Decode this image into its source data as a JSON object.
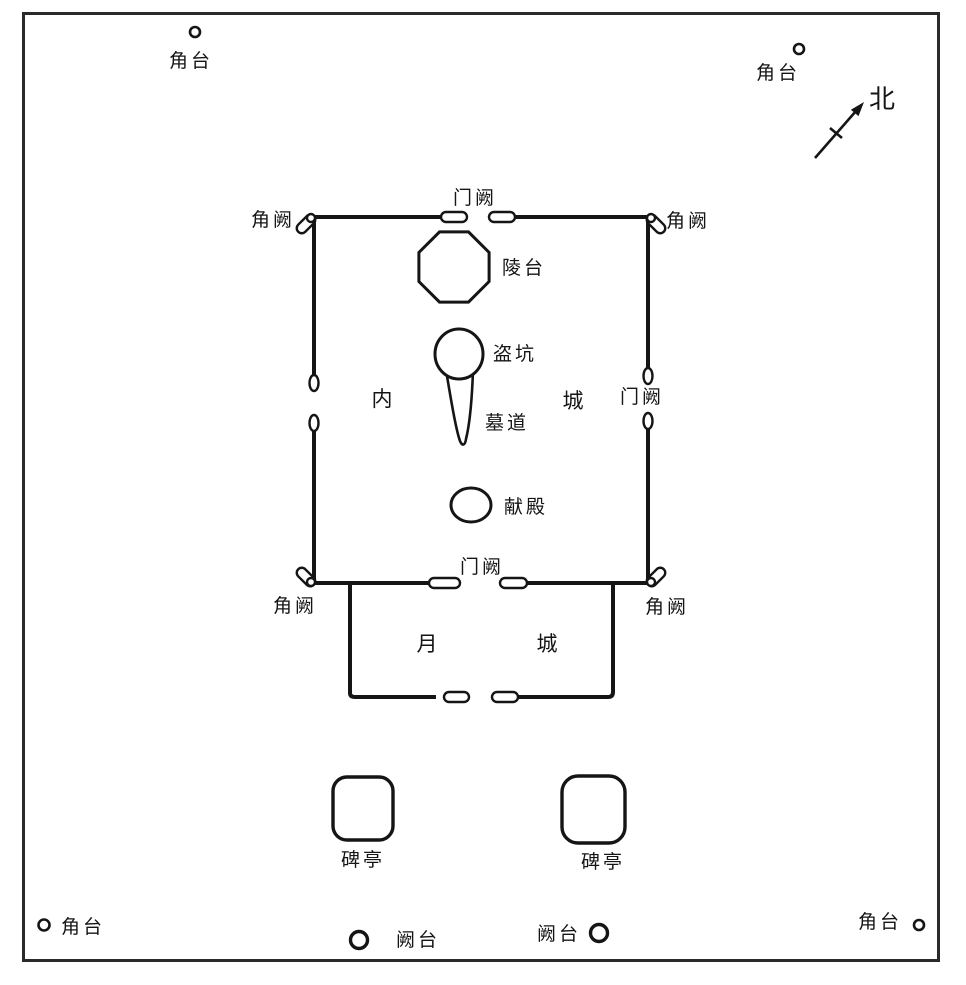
{
  "figure": {
    "kind": "archaeological-site-plan-diagram",
    "ink_color": "#151515",
    "background_color": "#ffffff"
  },
  "labels": {
    "corner_platform_nw": "角台",
    "corner_platform_ne": "角台",
    "north": "北",
    "corner_tower_nw": "角阙",
    "gate_tower_north": "门阙",
    "corner_tower_ne": "角阙",
    "mausoleum_platform": "陵台",
    "robbers_pit": "盗坑",
    "inner_city_nei": "内",
    "inner_city_cheng": "城",
    "gate_tower_east": "门阙",
    "tomb_passage": "墓道",
    "offering_hall": "献殿",
    "gate_tower_south": "门阙",
    "corner_tower_sw": "角阙",
    "corner_tower_se": "角阙",
    "moon_city_yue": "月",
    "moon_city_cheng": "城",
    "stele_pavilion_west": "碑亭",
    "stele_pavilion_east": "碑亭",
    "corner_platform_sw": "角台",
    "que_platform_west": "阙台",
    "que_platform_east": "阙台",
    "corner_platform_se": "角台"
  }
}
